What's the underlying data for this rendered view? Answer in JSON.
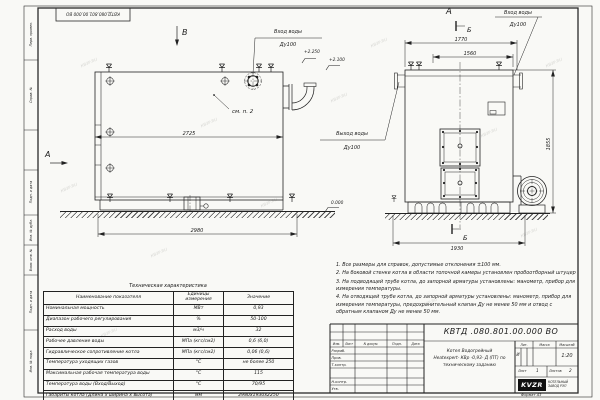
{
  "sheet": {
    "stamp": "КВТД.080.801.00.000 ВО",
    "format": "Формат    А3",
    "watermark": "КВЗР.RU"
  },
  "frame": {
    "labels": [
      "Перв. примен.",
      "Справ. №",
      "Подп. и дата",
      "Инв. № дубл.",
      "Взам. инв. №",
      "Подп. и дата",
      "Инв. № подл."
    ]
  },
  "side_view": {
    "marker_b": "В",
    "marker_a": "А",
    "see_note": "см. п. 2",
    "dim_body": "2725",
    "dim_total": "2980",
    "elev1": "+2.250",
    "elev2": "+2.100",
    "elev0": "0.000",
    "inlet1": "Вход воды",
    "inlet2": "Ду100",
    "outlet1": "Выход воды",
    "outlet2": "Ду100"
  },
  "front_view": {
    "marker_a": "А",
    "marker_b": "Б",
    "dim1": "1770",
    "dim2": "1560",
    "dim_h": "1855",
    "dim_w": "1930",
    "inlet1": "Вход воды",
    "inlet2": "Ду100"
  },
  "notes": {
    "n1": "1. Все размеры для справок, допустимые отклонения  ±100 мм.",
    "n2": "2. На боковой стенке котла в области топочной камеры установлен пробоотборный штуцер",
    "n3": "3. На подводящей трубе котла, до запорной арматуры установлены: манометр, прибор для измерения температуры.",
    "n4": "4. На отводящей трубе котла, до запорной арматуры установлены: манометр, прибор для измерения температуры, предохранительный клапан  Ду не менее  50 мм и отвод с обратным клапаном  Ду не менее 50 мм."
  },
  "table": {
    "title": "Техническая характеристика",
    "headers": {
      "name": "Наименование показателя",
      "unit": "Единицы измерения",
      "value": "Значение"
    },
    "rows": [
      {
        "name": "Номинальная мощность",
        "unit": "МВт",
        "value": "0,93"
      },
      {
        "name": "Диапазон рабочего регулирования",
        "unit": "%",
        "value": "50-100"
      },
      {
        "name": "Расход воды",
        "unit": "м3/ч",
        "value": "32"
      },
      {
        "name": "Рабочее давление воды",
        "unit": "МПа (кгс/см2)",
        "value": "0,6 (6,0)"
      },
      {
        "name": "Гидравлическое сопротивление котла",
        "unit": "МПа (кгс/см2)",
        "value": "0,06 (0,6)"
      },
      {
        "name": "Температура уходящих газов",
        "unit": "°С",
        "value": "не более 250"
      },
      {
        "name": "Максимальная рабочая температура воды",
        "unit": "°С",
        "value": "115"
      },
      {
        "name": "Температура воды (Вход/Выход)",
        "unit": "°С",
        "value": "70/95"
      },
      {
        "name": "Габариты котла (Длина х ширина х высота)",
        "unit": "мм",
        "value": "2980х1930х2250"
      }
    ]
  },
  "title_block": {
    "doc_number": "КВТД .080.801.00.000  ВО",
    "cols": [
      "Изм.",
      "Лист",
      "N докум.",
      "Подп.",
      "Дата"
    ],
    "roles": [
      "Разраб.",
      "Пров.",
      "Т.контр.",
      "Н.контр.",
      "Утв."
    ],
    "name1": "Котел Водогрейный",
    "name2": "Heatexpert- КВр -0,93- Д (ПТ)  по",
    "name3": "техническому заданию",
    "lit_label": "Лит.",
    "mass_label": "Масса",
    "scale_label": "Масштаб",
    "lit_value": "И",
    "scale_value": "1:20",
    "sheet_label": "Лист",
    "sheet_value": "1",
    "sheets_label": "Листов",
    "sheets_value": "2",
    "logo": "KVZR",
    "company1": "КОТЕЛЬНЫЙ",
    "company2": "ЗАВОД РЭП"
  }
}
